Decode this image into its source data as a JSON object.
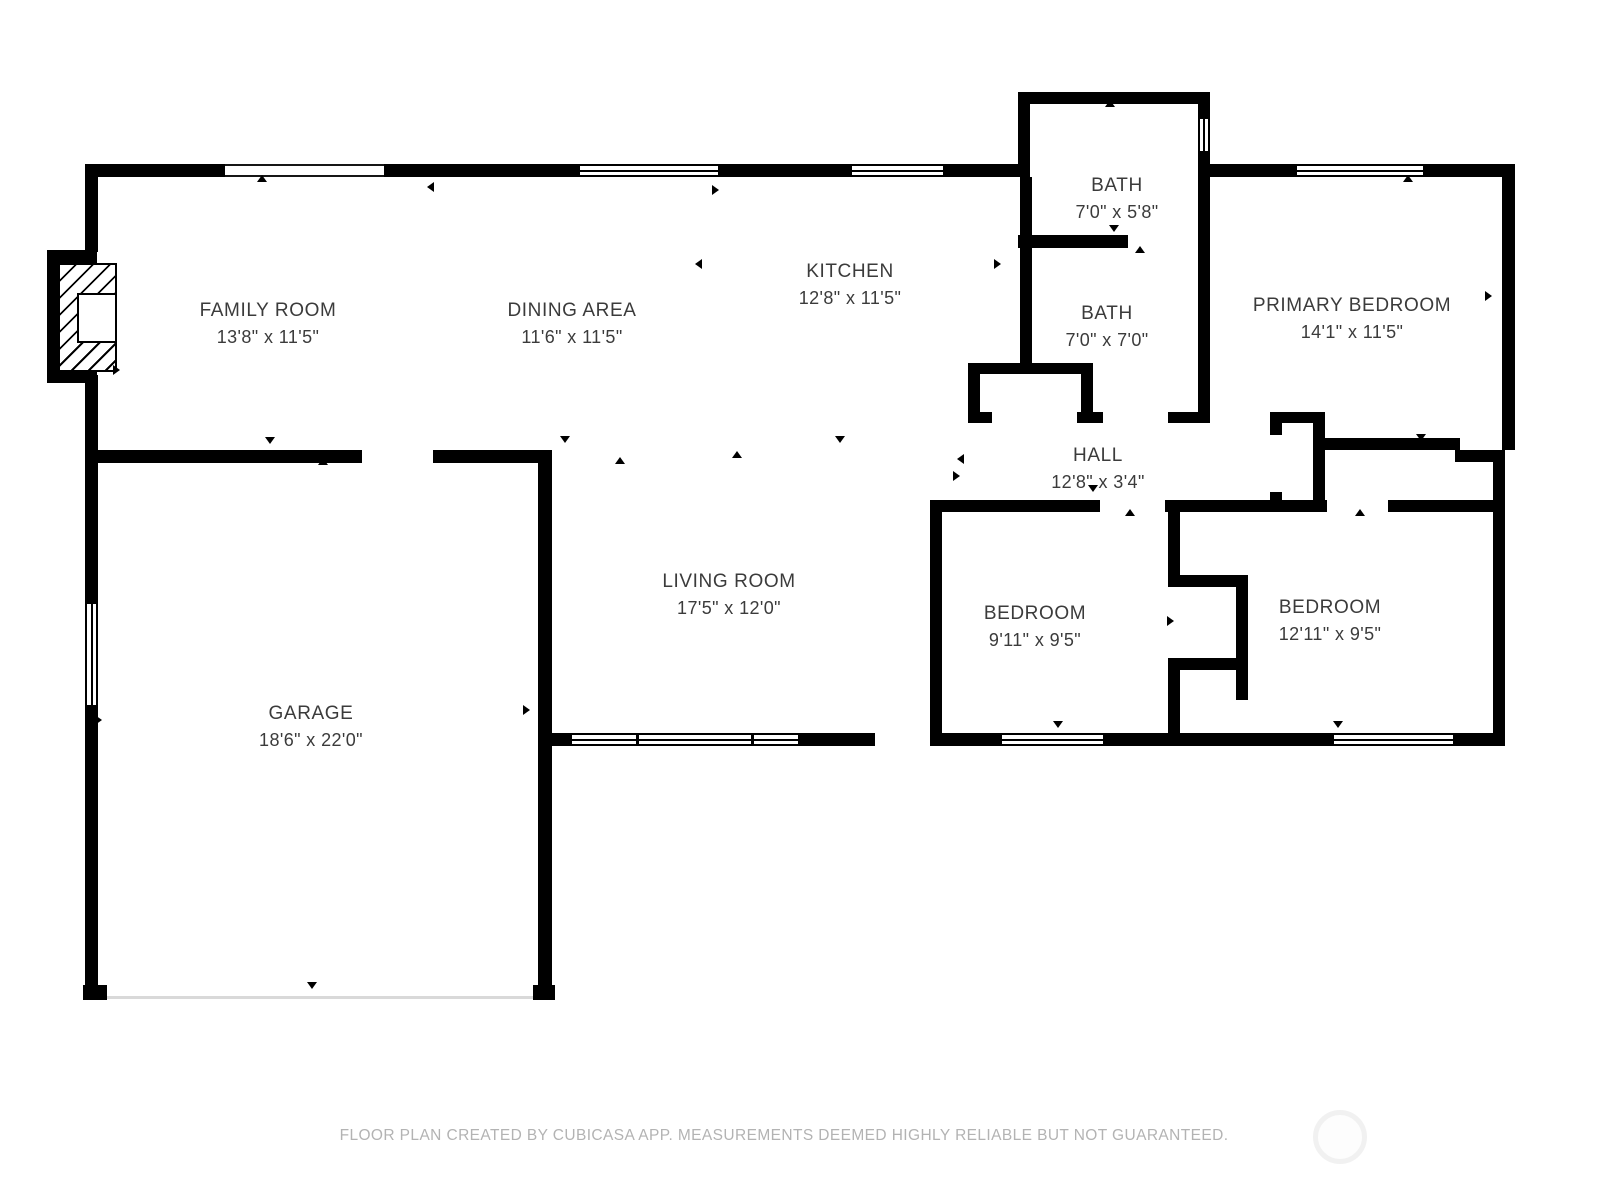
{
  "footer": {
    "text": "FLOOR PLAN CREATED BY CUBICASA APP. MEASUREMENTS DEEMED HIGHLY RELIABLE BUT NOT GUARANTEED."
  },
  "colors": {
    "wall": "#000000",
    "label_text": "#3b3b3b",
    "footer_text": "#b3b3b3",
    "background": "#ffffff"
  },
  "rooms": [
    {
      "id": "family-room",
      "name": "FAMILY ROOM",
      "dims": "13'8\" x 11'5\"",
      "cx": 268,
      "cy": 324
    },
    {
      "id": "dining-area",
      "name": "DINING AREA",
      "dims": "11'6\" x 11'5\"",
      "cx": 572,
      "cy": 324
    },
    {
      "id": "kitchen",
      "name": "KITCHEN",
      "dims": "12'8\" x 11'5\"",
      "cx": 850,
      "cy": 285
    },
    {
      "id": "bath-upper",
      "name": "BATH",
      "dims": "7'0\" x 5'8\"",
      "cx": 1117,
      "cy": 199
    },
    {
      "id": "bath-lower",
      "name": "BATH",
      "dims": "7'0\" x 7'0\"",
      "cx": 1107,
      "cy": 327
    },
    {
      "id": "primary-bedroom",
      "name": "PRIMARY BEDROOM",
      "dims": "14'1\" x 11'5\"",
      "cx": 1352,
      "cy": 319
    },
    {
      "id": "hall",
      "name": "HALL",
      "dims": "12'8\" x 3'4\"",
      "cx": 1098,
      "cy": 469
    },
    {
      "id": "living-room",
      "name": "LIVING ROOM",
      "dims": "17'5\" x 12'0\"",
      "cx": 729,
      "cy": 595
    },
    {
      "id": "bedroom-1",
      "name": "BEDROOM",
      "dims": "9'11\" x 9'5\"",
      "cx": 1035,
      "cy": 627
    },
    {
      "id": "bedroom-2",
      "name": "BEDROOM",
      "dims": "12'11\" x 9'5\"",
      "cx": 1330,
      "cy": 621
    },
    {
      "id": "garage",
      "name": "GARAGE",
      "dims": "18'6\" x 22'0\"",
      "cx": 311,
      "cy": 727
    }
  ],
  "geometry": {
    "walls": [
      [
        88,
        164,
        137,
        13
      ],
      [
        384,
        164,
        194,
        13
      ],
      [
        720,
        164,
        130,
        13
      ],
      [
        945,
        164,
        85,
        13
      ],
      [
        85,
        164,
        13,
        88
      ],
      [
        85,
        375,
        13,
        88
      ],
      [
        47,
        250,
        50,
        13
      ],
      [
        47,
        250,
        13,
        133
      ],
      [
        47,
        370,
        50,
        13
      ],
      [
        85,
        450,
        277,
        13
      ],
      [
        433,
        450,
        119,
        13
      ],
      [
        85,
        463,
        13,
        139
      ],
      [
        85,
        707,
        13,
        278
      ],
      [
        83,
        985,
        24,
        15
      ],
      [
        533,
        985,
        22,
        15
      ],
      [
        538,
        450,
        14,
        535
      ],
      [
        552,
        733,
        18,
        13
      ],
      [
        800,
        733,
        75,
        13
      ],
      [
        930,
        500,
        12,
        246
      ],
      [
        930,
        733,
        70,
        13
      ],
      [
        1105,
        733,
        63,
        13
      ],
      [
        1168,
        500,
        12,
        87
      ],
      [
        1168,
        575,
        80,
        12
      ],
      [
        1236,
        575,
        12,
        95
      ],
      [
        1168,
        658,
        80,
        12
      ],
      [
        1168,
        670,
        12,
        76
      ],
      [
        1236,
        670,
        12,
        30
      ],
      [
        1168,
        733,
        80,
        13
      ],
      [
        1248,
        733,
        84,
        13
      ],
      [
        1455,
        733,
        50,
        13
      ],
      [
        1493,
        450,
        12,
        296
      ],
      [
        1455,
        450,
        50,
        12
      ],
      [
        1325,
        438,
        135,
        12
      ],
      [
        1502,
        164,
        13,
        286
      ],
      [
        1210,
        164,
        85,
        13
      ],
      [
        1425,
        164,
        90,
        13
      ],
      [
        1018,
        92,
        192,
        12
      ],
      [
        1018,
        104,
        12,
        60
      ],
      [
        1198,
        104,
        12,
        13
      ],
      [
        1198,
        153,
        12,
        82
      ],
      [
        1018,
        235,
        110,
        13
      ],
      [
        1198,
        235,
        12,
        177
      ],
      [
        1020,
        177,
        12,
        186
      ],
      [
        968,
        363,
        125,
        11
      ],
      [
        968,
        374,
        12,
        38
      ],
      [
        968,
        412,
        24,
        11
      ],
      [
        1081,
        374,
        12,
        38
      ],
      [
        1077,
        412,
        26,
        11
      ],
      [
        1168,
        412,
        42,
        11
      ],
      [
        1270,
        412,
        55,
        11
      ],
      [
        1270,
        423,
        12,
        12
      ],
      [
        1270,
        492,
        12,
        20
      ],
      [
        1313,
        412,
        12,
        100
      ],
      [
        930,
        500,
        170,
        12
      ],
      [
        1165,
        500,
        162,
        12
      ],
      [
        1388,
        500,
        107,
        12
      ]
    ],
    "windows": [
      {
        "x": 578,
        "y": 164,
        "w": 142,
        "h": 13,
        "o": "h"
      },
      {
        "x": 850,
        "y": 164,
        "w": 95,
        "h": 13,
        "o": "h"
      },
      {
        "x": 1295,
        "y": 164,
        "w": 130,
        "h": 13,
        "o": "h"
      },
      {
        "x": 1198,
        "y": 117,
        "w": 12,
        "h": 36,
        "o": "v"
      },
      {
        "x": 85,
        "y": 602,
        "w": 13,
        "h": 105,
        "o": "v"
      },
      {
        "x": 570,
        "y": 733,
        "w": 230,
        "h": 13,
        "o": "h",
        "mullions": [
          0.28,
          0.78
        ]
      },
      {
        "x": 1000,
        "y": 733,
        "w": 105,
        "h": 13,
        "o": "h"
      },
      {
        "x": 1332,
        "y": 733,
        "w": 123,
        "h": 13,
        "o": "h"
      }
    ],
    "openings": [
      {
        "x": 225,
        "y": 164,
        "w": 159,
        "h": 13
      }
    ],
    "garage_door": {
      "x": 107,
      "y": 996,
      "w": 426
    },
    "fireplace": {
      "hatch": {
        "x": 58,
        "y": 263,
        "w": 59,
        "h": 109
      },
      "box": {
        "x": 77,
        "y": 293,
        "w": 40,
        "h": 50
      }
    },
    "markers": [
      {
        "x": 262,
        "y": 179,
        "d": "u"
      },
      {
        "x": 432,
        "y": 186,
        "d": "l"
      },
      {
        "x": 717,
        "y": 189,
        "d": "r"
      },
      {
        "x": 700,
        "y": 263,
        "d": "l"
      },
      {
        "x": 999,
        "y": 263,
        "d": "r"
      },
      {
        "x": 270,
        "y": 441,
        "d": "d"
      },
      {
        "x": 323,
        "y": 462,
        "d": "u"
      },
      {
        "x": 565,
        "y": 440,
        "d": "d"
      },
      {
        "x": 620,
        "y": 461,
        "d": "u"
      },
      {
        "x": 840,
        "y": 440,
        "d": "d"
      },
      {
        "x": 737,
        "y": 455,
        "d": "u"
      },
      {
        "x": 962,
        "y": 458,
        "d": "l"
      },
      {
        "x": 958,
        "y": 475,
        "d": "r"
      },
      {
        "x": 1093,
        "y": 489,
        "d": "d"
      },
      {
        "x": 1130,
        "y": 513,
        "d": "u"
      },
      {
        "x": 1360,
        "y": 513,
        "d": "u"
      },
      {
        "x": 1421,
        "y": 438,
        "d": "d"
      },
      {
        "x": 1408,
        "y": 179,
        "d": "u"
      },
      {
        "x": 1110,
        "y": 104,
        "d": "u"
      },
      {
        "x": 1114,
        "y": 229,
        "d": "d"
      },
      {
        "x": 1140,
        "y": 250,
        "d": "u"
      },
      {
        "x": 1490,
        "y": 295,
        "d": "r"
      },
      {
        "x": 1172,
        "y": 620,
        "d": "r"
      },
      {
        "x": 118,
        "y": 369,
        "d": "r"
      },
      {
        "x": 100,
        "y": 719,
        "d": "r"
      },
      {
        "x": 528,
        "y": 709,
        "d": "r"
      },
      {
        "x": 312,
        "y": 986,
        "d": "d"
      },
      {
        "x": 1058,
        "y": 725,
        "d": "d"
      },
      {
        "x": 1338,
        "y": 725,
        "d": "d"
      }
    ]
  }
}
